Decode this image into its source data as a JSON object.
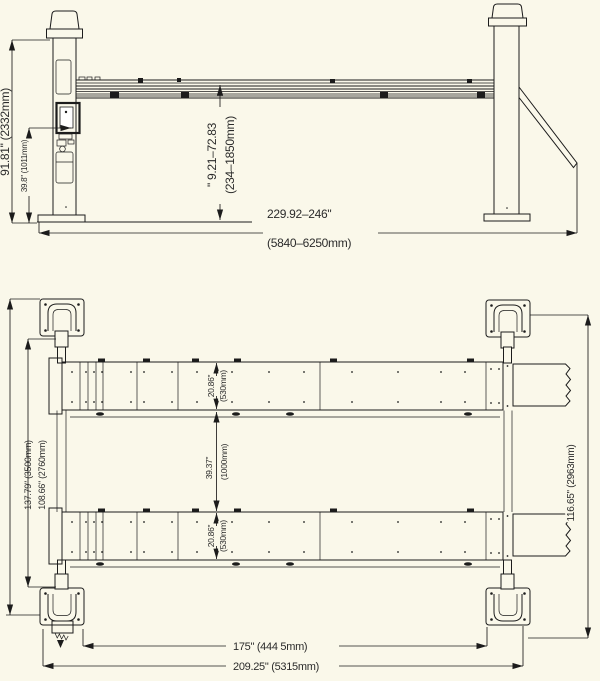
{
  "colors": {
    "background": "#FAF8EA",
    "line": "#1c1c1c",
    "text": "#2b2b2b"
  },
  "side_view": {
    "overall_height": "91.81\" (2332mm)",
    "base_height": "39.8\" (1011mm)",
    "lift_range_in": "\" 9.21–72.83",
    "lift_range_mm": "(234–1850mm)",
    "overall_length_in": "229.92–246\"",
    "overall_length_mm": "(5840–6250mm)"
  },
  "plan_view": {
    "overall_width": "137.79\" (3500mm)",
    "inner_width": "108.66\" (2760mm)",
    "runway_width_top_in": "20.86\"",
    "runway_width_top_mm": "(530mm)",
    "track_gap_in": "39.37\"",
    "track_gap_mm": "(1000mm)",
    "runway_width_bottom_in": "20.86\"",
    "runway_width_bottom_mm": "(530mm)",
    "side_length": "116.65\" (2963mm)",
    "drive_thru_length": "175\" (444 5mm)",
    "overall_length": "209.25\" (5315mm)"
  }
}
